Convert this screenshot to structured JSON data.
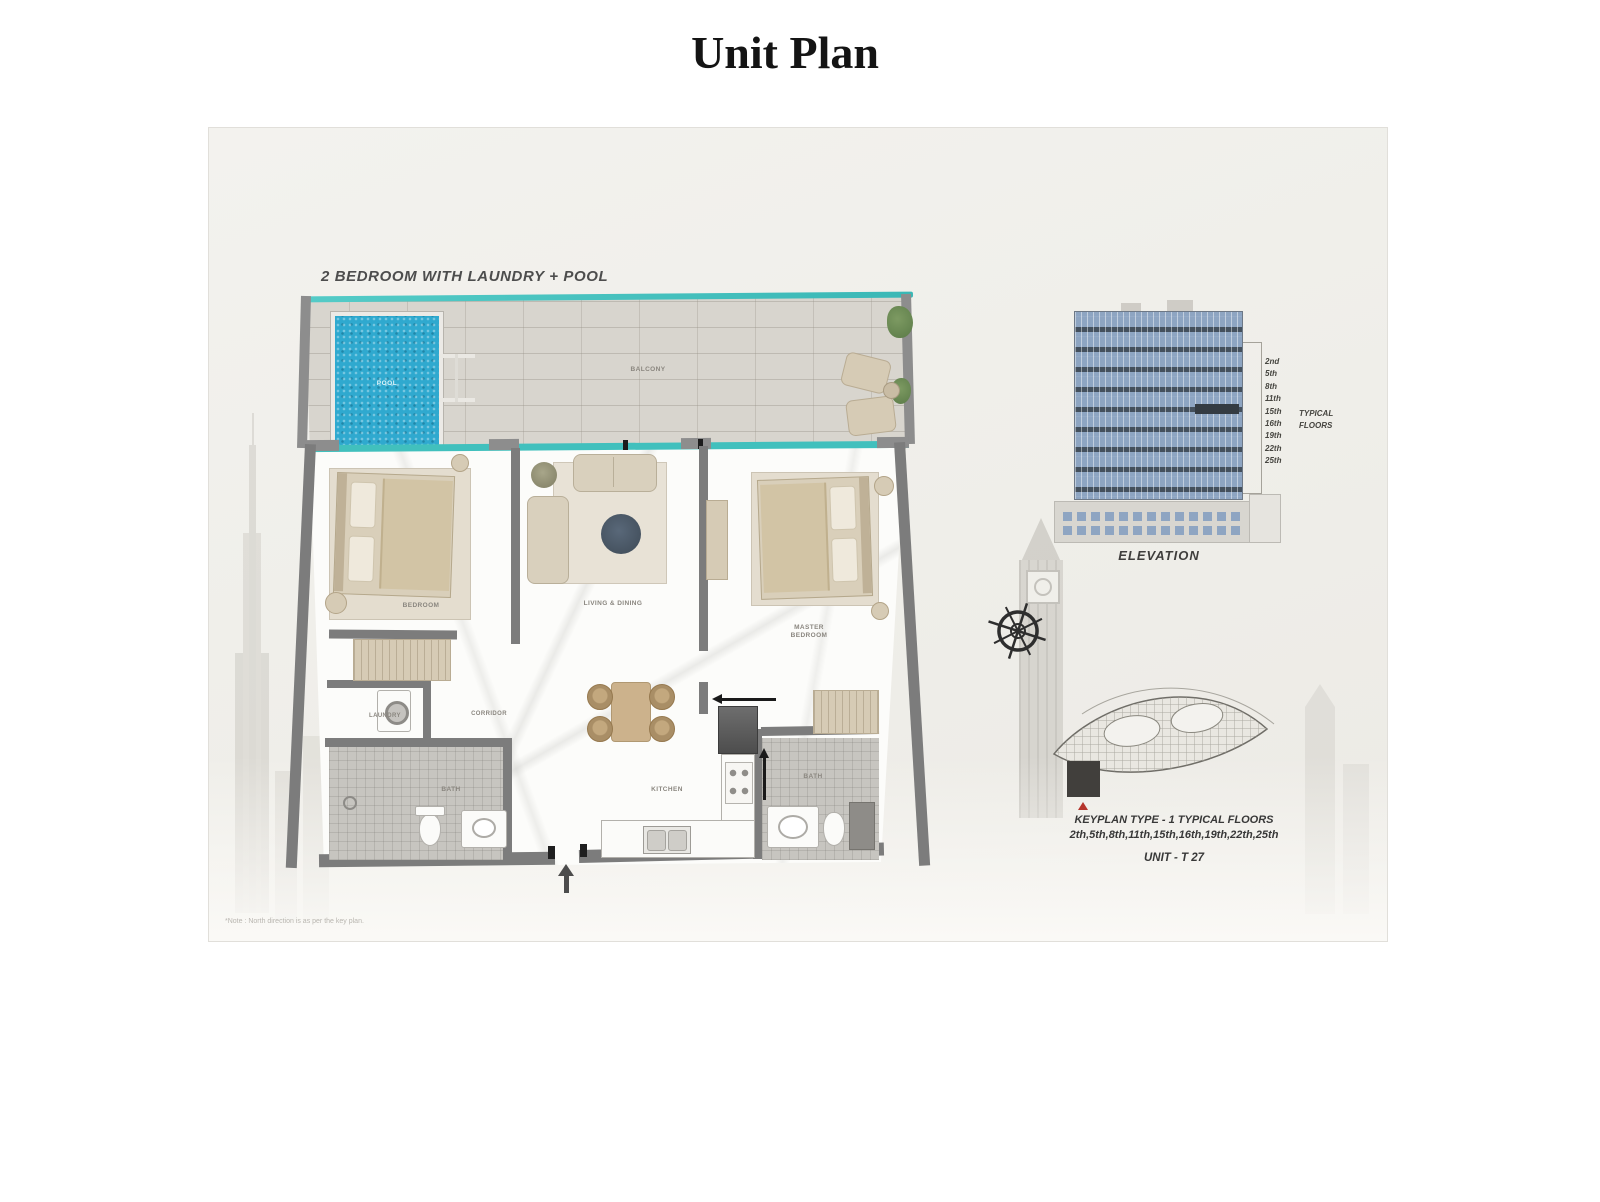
{
  "title": "Unit Plan",
  "plan": {
    "heading": "2 BEDROOM WITH LAUNDRY + POOL",
    "note": "*Note : North direction is as per the key plan.",
    "rooms": {
      "pool": "POOL",
      "balcony": "BALCONY",
      "bedroom": "BEDROOM",
      "living": "LIVING & DINING",
      "master1": "MASTER",
      "master2": "BEDROOM",
      "laundry": "LAUNDRY",
      "corridor": "CORRIDOR",
      "bath1": "BATH",
      "kitchen": "KITCHEN",
      "bath2": "BATH"
    }
  },
  "elevation": {
    "label": "ELEVATION",
    "typical1": "TYPICAL",
    "typical2": "FLOORS",
    "floors": [
      "2nd",
      "5th",
      "8th",
      "11th",
      "15th",
      "16th",
      "19th",
      "22th",
      "25th"
    ]
  },
  "keyplan": {
    "title": "KEYPLAN TYPE - 1 TYPICAL FLOORS",
    "floors": "2th,5th,8th,11th,15th,16th,19th,22th,25th",
    "unit": "UNIT - T 27"
  },
  "colors": {
    "pool_blue": "#2fa9cf",
    "glass_teal": "#45c4c0",
    "wall_gray": "#7c7c7c",
    "facade_blue": "#8ea5c2",
    "facade_dark": "#44505d",
    "highlight_dark": "#343b42",
    "marker_red": "#b5342c"
  }
}
